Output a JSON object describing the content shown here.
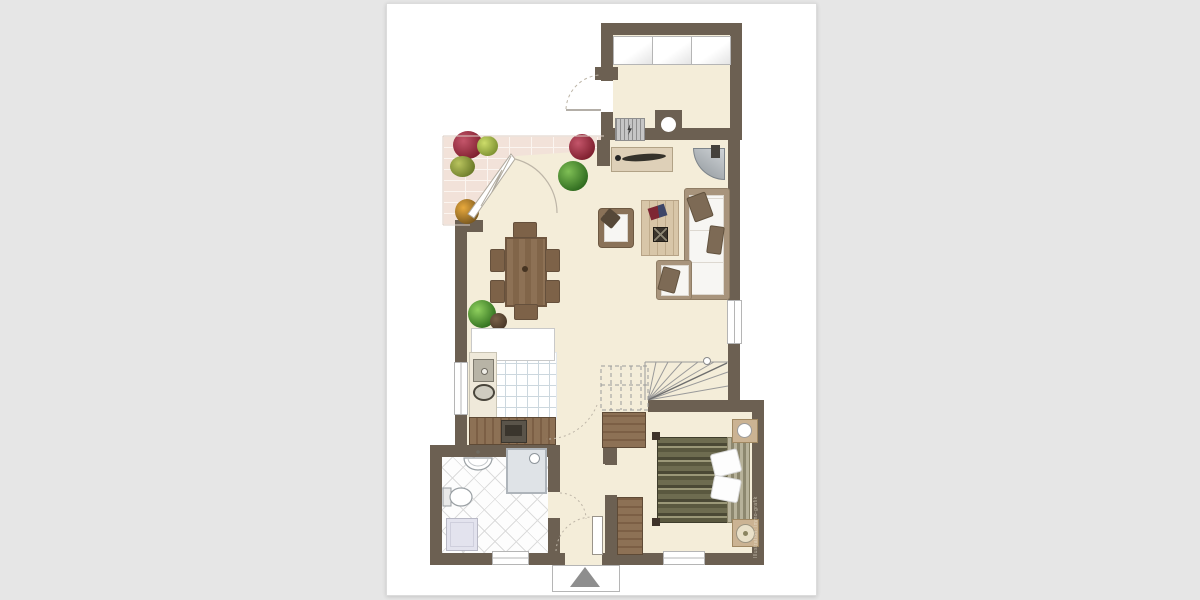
{
  "page": {
    "background": "#e6e6e6",
    "card_background": "#ffffff",
    "description": "Architectural floor plan of a single-storey apartment (no text labels on plan)"
  },
  "palette": {
    "wall": "#6c6052",
    "floor": "#f4edd9",
    "brick": "#f2e2d9",
    "brick_joint": "#fbf5f0",
    "tile_line": "#ccd7de",
    "bath_tile_line": "#dcdcdc",
    "wood_mid": "#8d7155",
    "wood_dark": "#7c5f45",
    "wood_light": "#d8c6a8",
    "sofa_frame": "#a8947c",
    "cushion_white": "#f7f6f3",
    "pillow_brown": "#7d6a55",
    "duvet_dark": "#4b4935",
    "duvet_mid": "#6e6c50",
    "duvet_light": "#9b9878",
    "fixture_gray": "#b9bcc0",
    "appliance_dark": "#4a443b",
    "plant_green": "#4f8a38",
    "plant_red": "#9c2c3c",
    "pot_brown": "#5e4936",
    "arc_line": "#bdb5a7",
    "window_line": "#b5b5b5",
    "entry_triangle": "#8e8e8e"
  },
  "watermark": {
    "text": "Illustration: immo-grafik"
  }
}
